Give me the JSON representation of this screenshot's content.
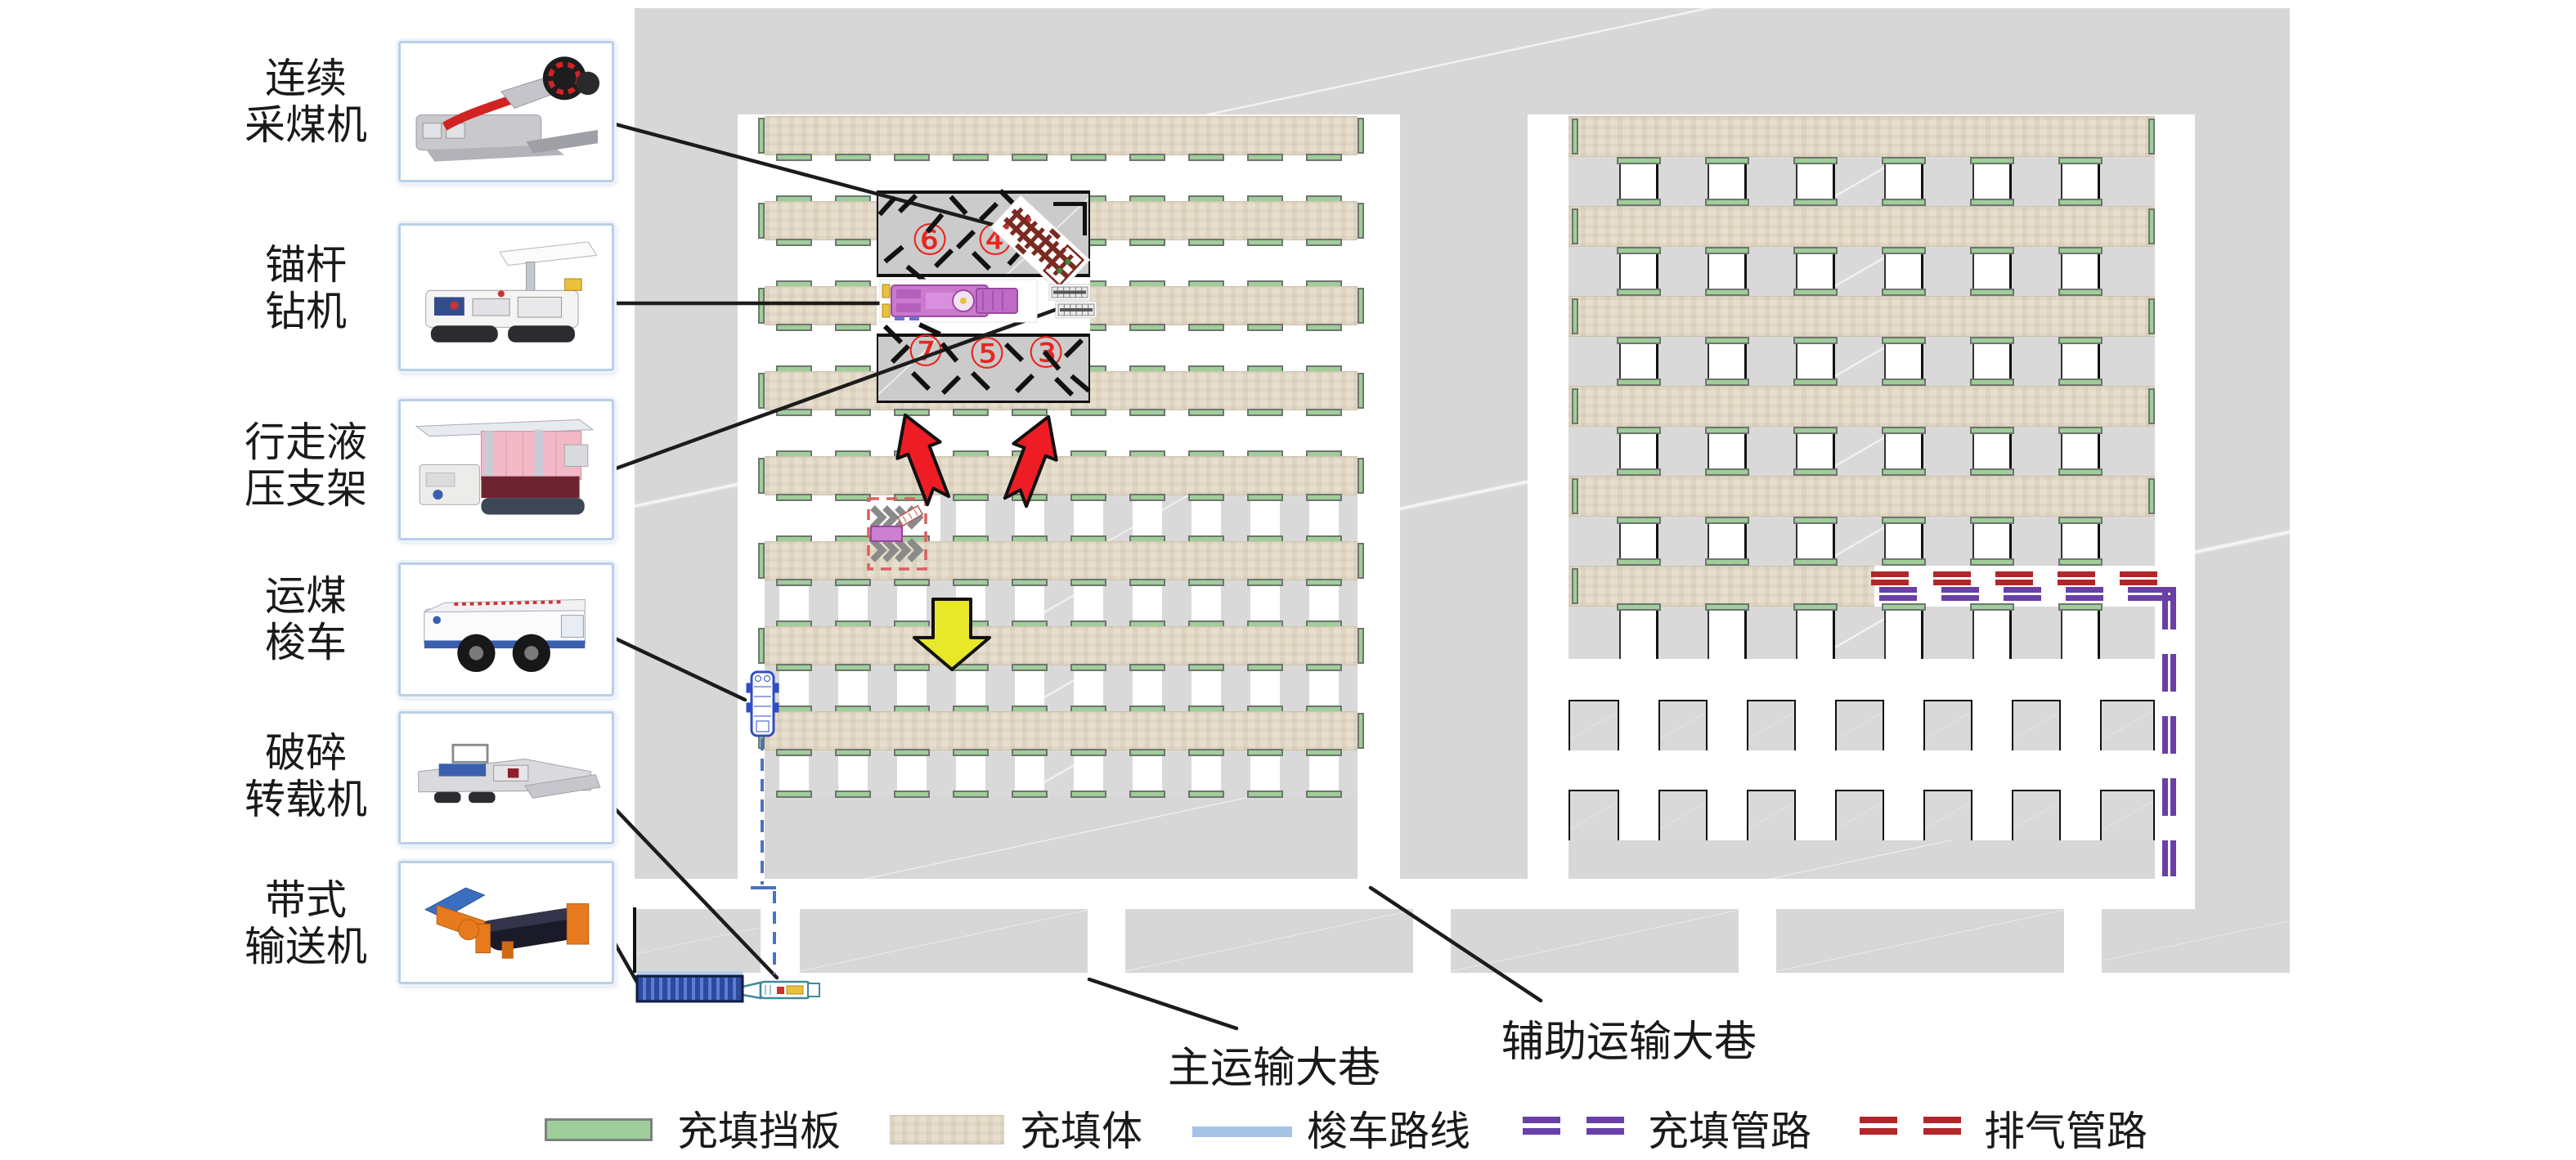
{
  "equipment": [
    {
      "id": "continuous-miner",
      "label_lines": [
        "连续",
        "采煤机"
      ]
    },
    {
      "id": "roof-bolter",
      "label_lines": [
        "锚杆",
        "钻机"
      ]
    },
    {
      "id": "walking-support",
      "label_lines": [
        "行走液",
        "压支架"
      ]
    },
    {
      "id": "shuttle-car",
      "label_lines": [
        "运煤",
        "梭车"
      ]
    },
    {
      "id": "crusher-loader",
      "label_lines": [
        "破碎",
        "转载机"
      ]
    },
    {
      "id": "belt-conveyor",
      "label_lines": [
        "带式",
        "输送机"
      ]
    }
  ],
  "map": {
    "roadway_labels": {
      "main": "主运输大巷",
      "auxiliary": "辅助运输大巷"
    },
    "work_area_numbers": {
      "top": [
        "⑥",
        "④"
      ],
      "bottom": [
        "⑦",
        "⑤",
        "③"
      ]
    }
  },
  "legend": {
    "items": [
      {
        "swatch": "filling-baffle",
        "label": "充填挡板"
      },
      {
        "swatch": "filling-body",
        "label": "充填体"
      },
      {
        "swatch": "shuttle-route",
        "label": "梭车路线"
      },
      {
        "swatch": "filling-pipeline",
        "label": "充填管路"
      },
      {
        "swatch": "exhaust-pipeline",
        "label": "排气管路"
      }
    ]
  },
  "colors": {
    "baffle_green": "#9fce9a",
    "fill_body_beige": "#e7decd",
    "shuttle_route_blue": "#4a72c4",
    "shuttle_legend_blue": "#a6c3e6",
    "filling_pipe_purple": "#6a3fa8",
    "exhaust_pipe_red": "#b2262a",
    "advance_arrow_red": "#ee1c25",
    "advance_arrow_yellow": "#e7e829",
    "sequence_number_red": "#e8251f"
  }
}
